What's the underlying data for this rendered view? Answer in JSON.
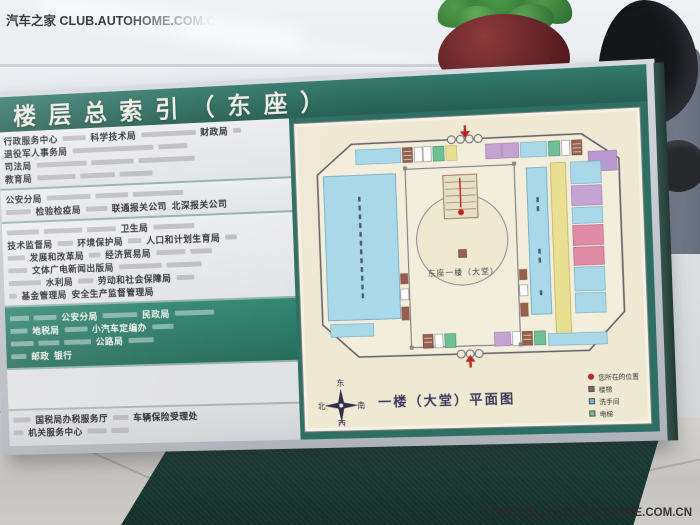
{
  "watermark": {
    "top_left": "汽车之家 CLUB.AUTOHOME.COM.CN",
    "bottom_right": "汽车之家 CLUB.AUTOHOME.COM.CN"
  },
  "board": {
    "title": "楼层总索引（东座）",
    "directory": {
      "bands": [
        {
          "bg": "light",
          "rows": [
            [
              {
                "t": "行政服务中心"
              },
              {
                "s": 24
              },
              {
                "t": "科学技术局"
              },
              {
                "s": 56
              },
              {
                "t": "财政局"
              },
              {
                "s": 8
              }
            ],
            [
              {
                "t": "退役军人事务局"
              },
              {
                "s": 84
              },
              {
                "s": 30
              }
            ],
            [
              {
                "t": "司法局"
              },
              {
                "s": 52
              },
              {
                "s": 44
              },
              {
                "s": 58
              }
            ],
            [
              {
                "t": "教育局"
              },
              {
                "s": 40
              },
              {
                "s": 36
              },
              {
                "s": 34
              }
            ]
          ]
        },
        {
          "bg": "light",
          "rows": [
            [
              {
                "t": "公安分局"
              },
              {
                "s": 46
              },
              {
                "s": 34
              },
              {
                "s": 52
              }
            ],
            [
              {
                "s": 26
              },
              {
                "t": "检验检疫局"
              },
              {
                "s": 22
              },
              {
                "t": "联通报关公司"
              },
              {
                "t": "北深报关公司"
              }
            ]
          ]
        },
        {
          "bg": "light",
          "rows": [
            [
              {
                "s": 34
              },
              {
                "s": 40
              },
              {
                "s": 30
              },
              {
                "t": "卫生局"
              },
              {
                "s": 42
              }
            ],
            [
              {
                "t": "技术监督局"
              },
              {
                "s": 16
              },
              {
                "t": "环境保护局"
              },
              {
                "s": 14
              },
              {
                "t": "人口和计划生育局"
              },
              {
                "s": 12
              }
            ],
            [
              {
                "s": 18
              },
              {
                "t": "发展和改革局"
              },
              {
                "s": 12
              },
              {
                "t": "经济贸易局"
              },
              {
                "s": 30
              },
              {
                "s": 22
              }
            ],
            [
              {
                "s": 20
              },
              {
                "t": "文体广电新闻出版局"
              },
              {
                "s": 44
              },
              {
                "s": 36
              }
            ],
            [
              {
                "s": 34
              },
              {
                "t": "水利局"
              },
              {
                "s": 16
              },
              {
                "t": "劳动和社会保障局"
              },
              {
                "s": 18
              }
            ],
            [
              {
                "s": 8
              },
              {
                "t": "基金管理局"
              },
              {
                "t": "安全生产监督管理局"
              }
            ]
          ]
        },
        {
          "bg": "green",
          "rows": [
            [
              {
                "s": 20
              },
              {
                "s": 24
              },
              {
                "t": "公安分局"
              },
              {
                "s": 36
              },
              {
                "t": "民政局"
              },
              {
                "s": 40
              }
            ],
            [
              {
                "s": 18
              },
              {
                "t": "地税局"
              },
              {
                "s": 24
              },
              {
                "t": "小汽车定编办"
              },
              {
                "s": 22
              }
            ],
            [
              {
                "s": 24
              },
              {
                "s": 22
              },
              {
                "s": 28
              },
              {
                "t": "公路局"
              },
              {
                "s": 26
              }
            ],
            [
              {
                "s": 16
              },
              {
                "t": "邮政"
              },
              {
                "t": "银行"
              }
            ]
          ]
        },
        {
          "bg": "blank",
          "rows": []
        },
        {
          "bg": "gray",
          "rows": [
            [
              {
                "s": 18
              },
              {
                "t": "国税局办税服务厅"
              },
              {
                "s": 16
              },
              {
                "t": "车辆保险受理处"
              }
            ],
            [
              {
                "s": 10
              },
              {
                "t": "机关服务中心"
              },
              {
                "s": 20
              },
              {
                "s": 18
              }
            ]
          ]
        }
      ]
    },
    "map": {
      "lobby_label": "东座一楼（大堂）",
      "caption": "一楼（大堂）平面图",
      "compass": {
        "top": "东",
        "left": "北",
        "right": "南",
        "bottom": "西"
      },
      "legend": [
        {
          "shape": "dot",
          "swatch": "#b52a2a",
          "label": "您所在的位置"
        },
        {
          "shape": "square",
          "swatch": "#96604e",
          "label": "楼梯"
        },
        {
          "shape": "square",
          "swatch": "#74b4d8",
          "label": "洗手间"
        },
        {
          "shape": "square",
          "swatch": "#6fc096",
          "label": "电梯"
        }
      ]
    }
  },
  "colors": {
    "board_green": "#2d6f62",
    "panel_green": "#2f8671",
    "map_cream": "#efe9d4",
    "map_blue": "#a9d8e8",
    "map_yellow": "#e9df92",
    "map_purple": "#c5a3d3",
    "map_pink": "#df8aa6",
    "map_elevator_green": "#6fc096",
    "map_stairs_brown": "#96604e",
    "arrow_red": "#c22222"
  }
}
